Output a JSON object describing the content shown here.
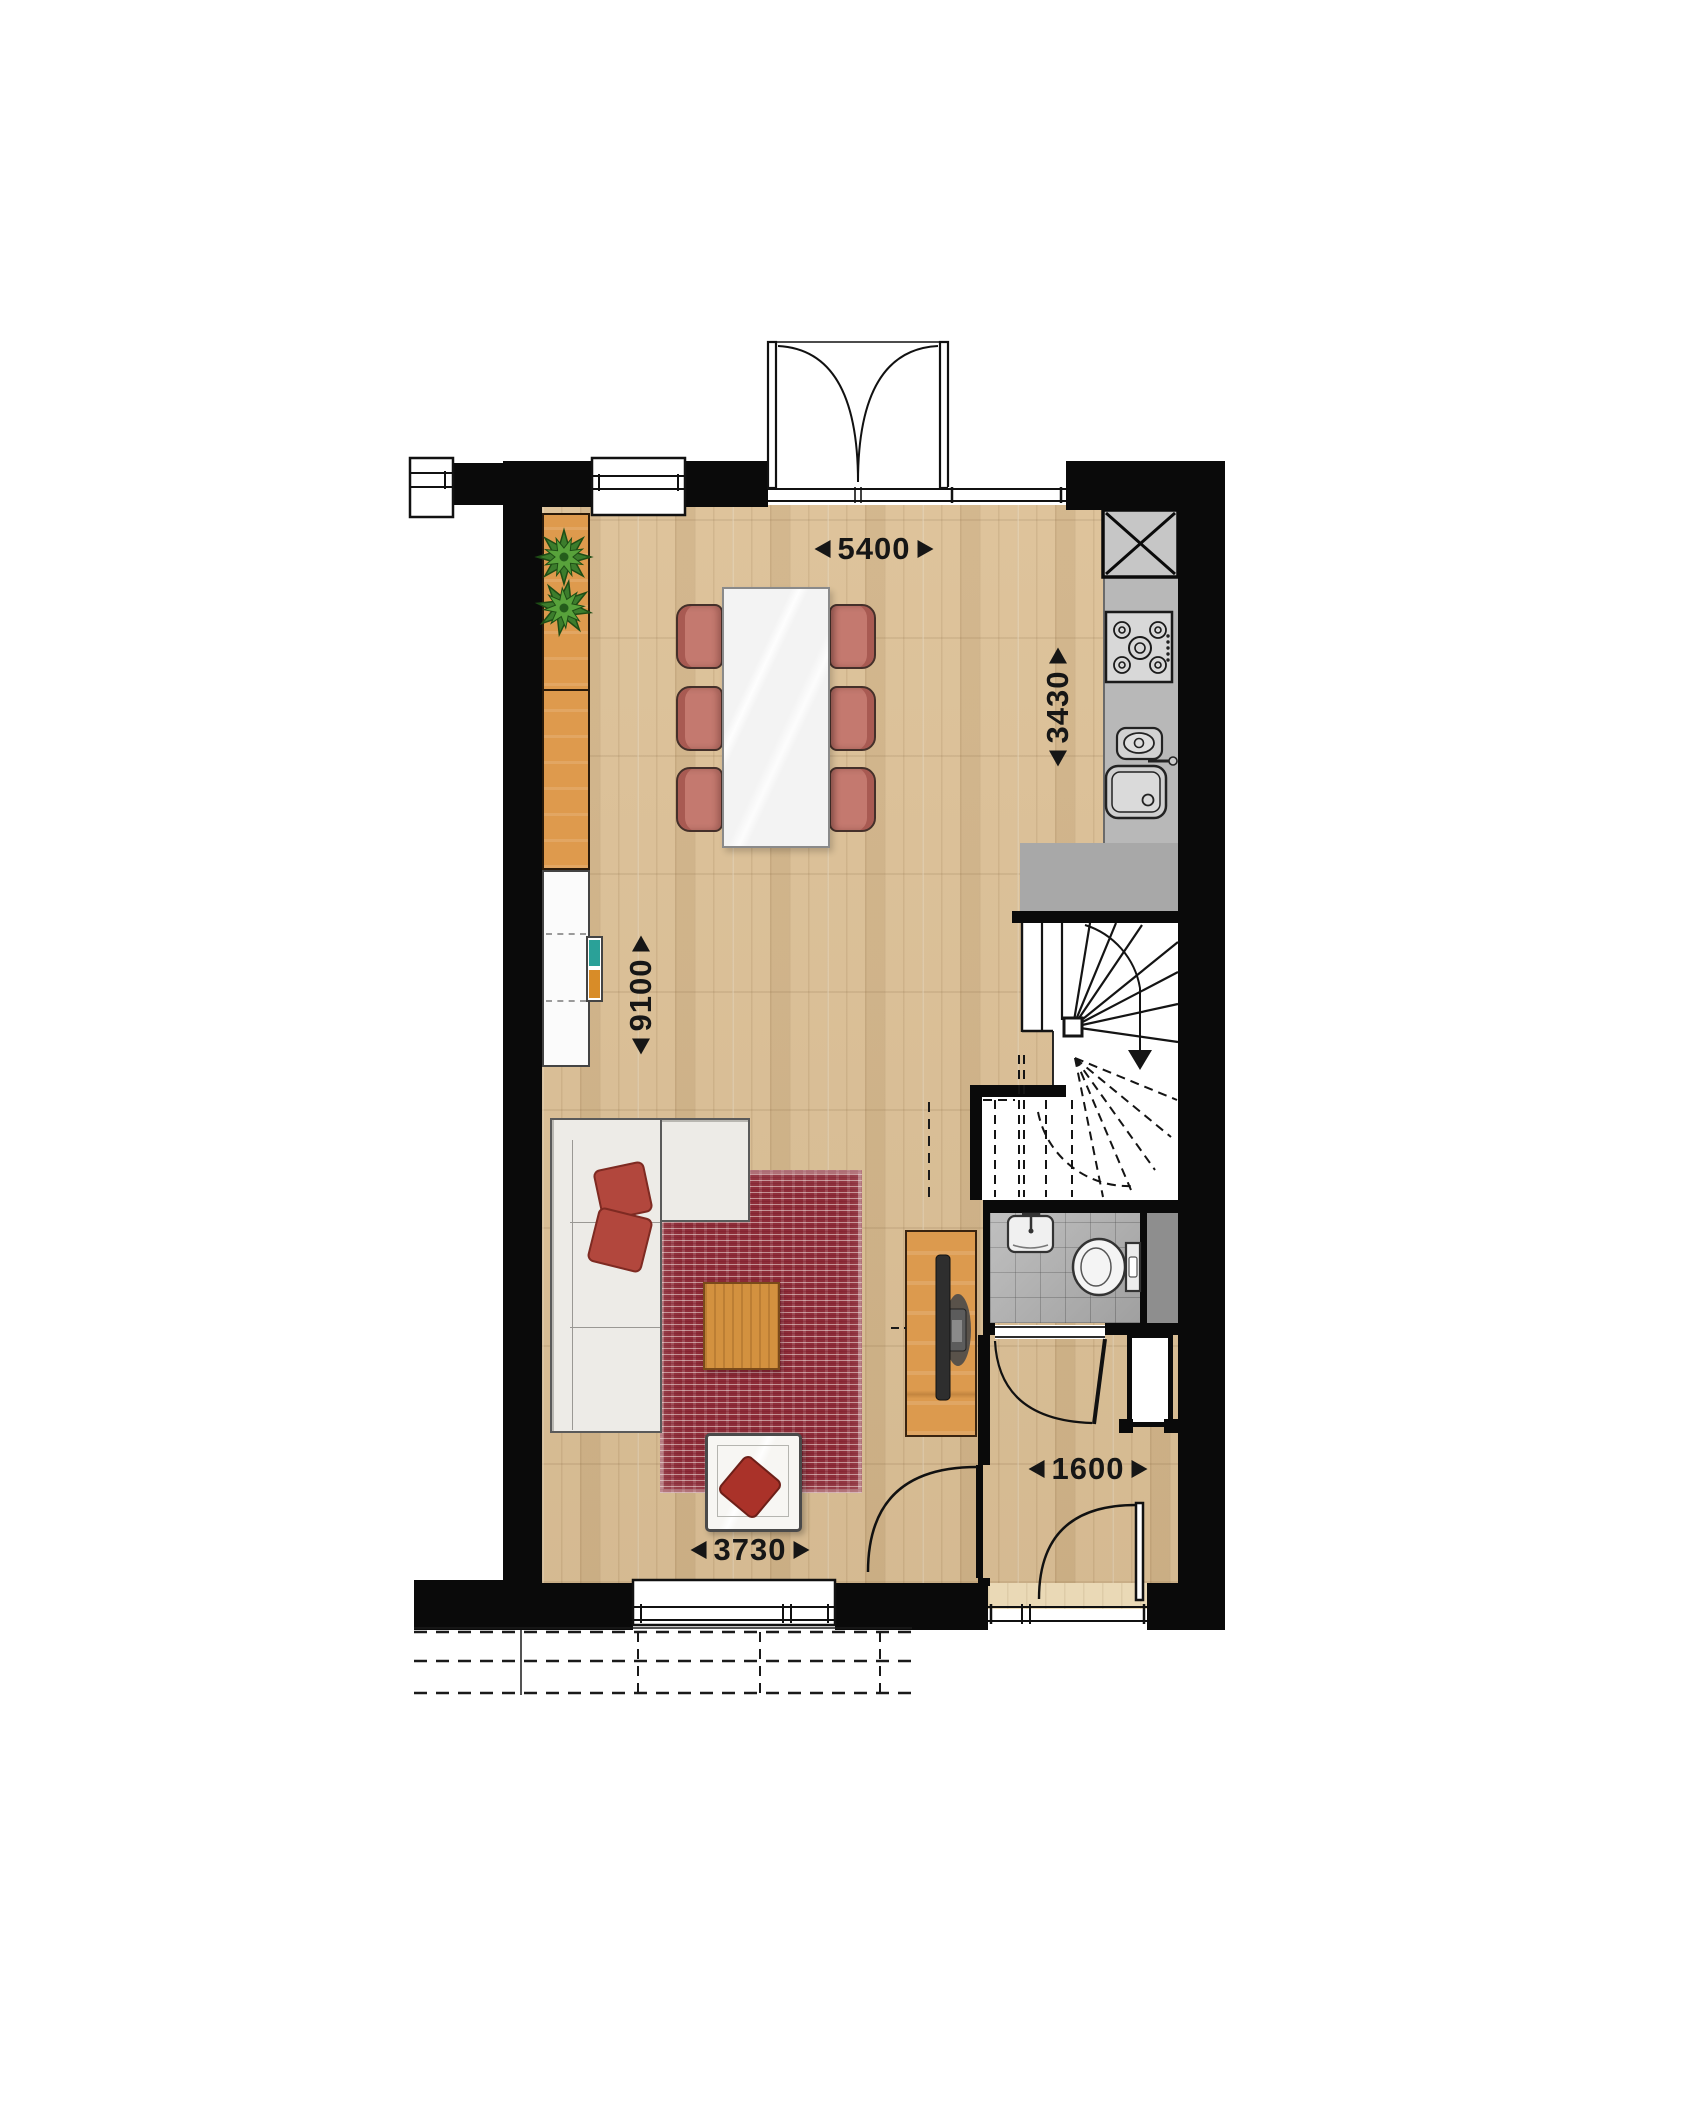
{
  "plan": {
    "type": "floor-plan",
    "dimension_labels": {
      "top_width": "5400",
      "right_depth": "3430",
      "left_length": "9100",
      "bottom_width": "3730",
      "hall_width": "1600"
    },
    "colors": {
      "wall": "#0a0a0a",
      "wood_floor": "#dcc096",
      "kitchen_counter": "#b8b8b8",
      "wc_tile": "#b2b2b2",
      "cabinet_wood": "#de9a4d",
      "rug": "#8d2c38",
      "dining_chair": "#c4796f",
      "sofa": "#edebe7",
      "pillow_accent": "#b2473d",
      "plant": "#58a23b"
    }
  }
}
